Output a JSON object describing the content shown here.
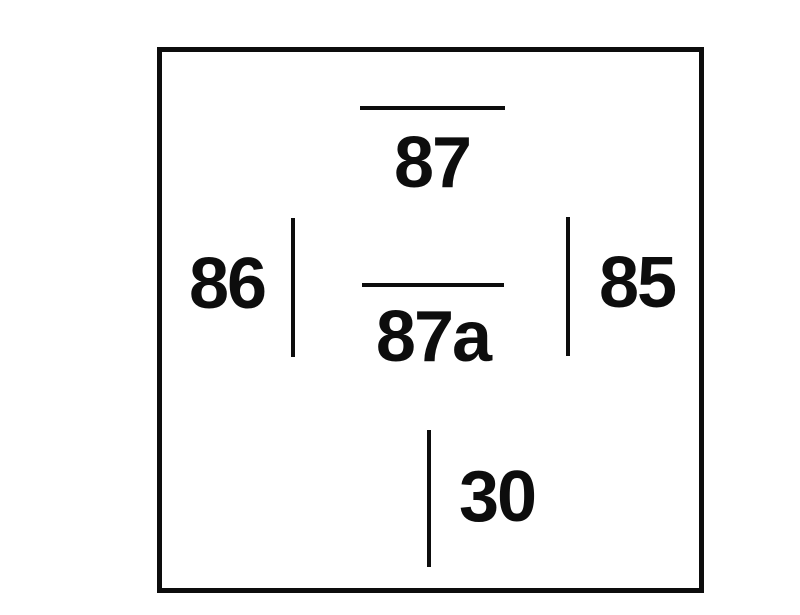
{
  "diagram": {
    "type": "relay-terminal-pin-diagram",
    "colors": {
      "background": "#ffffff",
      "ink": "#0d0d0d"
    },
    "pins": {
      "p87": {
        "label": "87"
      },
      "p87a": {
        "label": "87a"
      },
      "p86": {
        "label": "86"
      },
      "p85": {
        "label": "85"
      },
      "p30": {
        "label": "30"
      }
    }
  }
}
